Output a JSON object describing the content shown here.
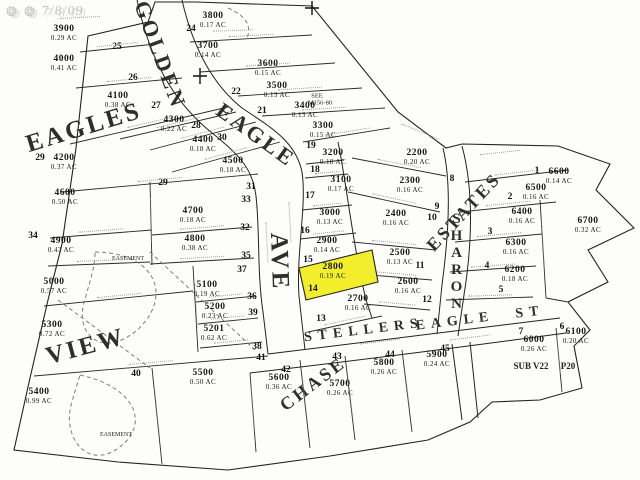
{
  "watermark": {
    "icon": "rosette-icon",
    "icon_glyphs": "❂ ❂",
    "text": "7/8/09"
  },
  "colors": {
    "highlight": "#f3ee2c",
    "line": "#222222",
    "paper": "#fdfdfc",
    "watermark": "#c4c4c4"
  },
  "highlighted_lot": {
    "id": "2800",
    "area": "0.19 AC",
    "lot_no": "14"
  },
  "streets": [
    {
      "name": "GOLDEN",
      "x": 160,
      "y": 55,
      "rot": 70,
      "size": 22
    },
    {
      "name": "EAGLE",
      "x": 256,
      "y": 135,
      "rot": 36,
      "size": 22
    },
    {
      "name": "AVE",
      "x": 279,
      "y": 262,
      "rot": 88,
      "size": 25
    },
    {
      "name": "EAGLES",
      "x": 84,
      "y": 128,
      "rot": -17,
      "size": 25
    },
    {
      "name": "VIEW",
      "x": 86,
      "y": 347,
      "rot": -15,
      "size": 25
    },
    {
      "name": "ESTATES",
      "x": 464,
      "y": 212,
      "rot": -47,
      "size": 18
    },
    {
      "name": "SHARON",
      "x": 456,
      "y": 262,
      "rot": 0,
      "size": 15,
      "vertical": true
    },
    {
      "name": "CHASE",
      "x": 313,
      "y": 384,
      "rot": -37,
      "size": 18
    },
    {
      "name": "STELLERS",
      "x": 364,
      "y": 331,
      "rot": -7,
      "size": 14,
      "spaced": true
    },
    {
      "name": "EAGLE",
      "x": 455,
      "y": 322,
      "rot": -7,
      "size": 14,
      "spaced": true
    },
    {
      "name": "ST",
      "x": 530,
      "y": 313,
      "rot": -7,
      "size": 14,
      "spaced": true
    }
  ],
  "lots": [
    {
      "id": "3900",
      "area": "0.29 AC",
      "x": 64,
      "y": 34
    },
    {
      "id": "3800",
      "area": "0.17 AC",
      "x": 213,
      "y": 21
    },
    {
      "id": "3700",
      "area": "0.14 AC",
      "x": 208,
      "y": 51
    },
    {
      "id": "3600",
      "area": "0.15 AC",
      "x": 268,
      "y": 69
    },
    {
      "id": "3500",
      "area": "0.13 AC",
      "x": 277,
      "y": 91
    },
    {
      "id": "3400",
      "area": "0.13 AC",
      "x": 305,
      "y": 111
    },
    {
      "id": "3300",
      "area": "0.15 AC",
      "x": 323,
      "y": 131
    },
    {
      "id": "3200",
      "area": "0.18 AC",
      "x": 333,
      "y": 158
    },
    {
      "id": "3100",
      "area": "0.17 AC",
      "x": 341,
      "y": 185
    },
    {
      "id": "3000",
      "area": "0.13 AC",
      "x": 330,
      "y": 218
    },
    {
      "id": "2900",
      "area": "0.14 AC",
      "x": 327,
      "y": 246
    },
    {
      "id": "2800",
      "area": "0.19 AC",
      "x": 333,
      "y": 272,
      "highlight": true
    },
    {
      "id": "2700",
      "area": "0.16 AC",
      "x": 358,
      "y": 304
    },
    {
      "id": "2200",
      "area": "0.20 AC",
      "x": 417,
      "y": 158
    },
    {
      "id": "2300",
      "area": "0.16 AC",
      "x": 410,
      "y": 186
    },
    {
      "id": "2400",
      "area": "0.16 AC",
      "x": 396,
      "y": 219
    },
    {
      "id": "2500",
      "area": "0.13 AC",
      "x": 400,
      "y": 258
    },
    {
      "id": "2600",
      "area": "0.16 AC",
      "x": 408,
      "y": 287
    },
    {
      "id": "4000",
      "area": "0.41 AC",
      "x": 64,
      "y": 64
    },
    {
      "id": "4100",
      "area": "0.38 AC",
      "x": 118,
      "y": 101
    },
    {
      "id": "4300",
      "area": "0.22 AC",
      "x": 174,
      "y": 125
    },
    {
      "id": "4400",
      "area": "0.18 AC",
      "x": 203,
      "y": 145
    },
    {
      "id": "4500",
      "area": "0.18 AC",
      "x": 233,
      "y": 166
    },
    {
      "id": "4200",
      "area": "0.37 AC",
      "x": 64,
      "y": 163
    },
    {
      "id": "4600",
      "area": "0.50 AC",
      "x": 65,
      "y": 198
    },
    {
      "id": "4700",
      "area": "0.18 AC",
      "x": 193,
      "y": 216
    },
    {
      "id": "4800",
      "area": "0.38 AC",
      "x": 195,
      "y": 244
    },
    {
      "id": "4900",
      "area": "0.43 AC",
      "x": 61,
      "y": 246
    },
    {
      "id": "5000",
      "area": "0.57 AC",
      "x": 54,
      "y": 287
    },
    {
      "id": "5100",
      "area": "0.19 AC",
      "x": 207,
      "y": 290
    },
    {
      "id": "5200",
      "area": "0.23 AC",
      "x": 215,
      "y": 312
    },
    {
      "id": "5201",
      "area": "0.62 AC",
      "x": 214,
      "y": 334
    },
    {
      "id": "5300",
      "area": "0.72 AC",
      "x": 52,
      "y": 330
    },
    {
      "id": "5400",
      "area": "0.99 AC",
      "x": 39,
      "y": 397
    },
    {
      "id": "5500",
      "area": "0.50 AC",
      "x": 203,
      "y": 378
    },
    {
      "id": "5600",
      "area": "0.36 AC",
      "x": 279,
      "y": 383
    },
    {
      "id": "5700",
      "area": "0.26 AC",
      "x": 340,
      "y": 389
    },
    {
      "id": "5800",
      "area": "0.26 AC",
      "x": 384,
      "y": 368
    },
    {
      "id": "5900",
      "area": "0.24 AC",
      "x": 437,
      "y": 360
    },
    {
      "id": "6000",
      "area": "0.26 AC",
      "x": 534,
      "y": 345
    },
    {
      "id": "6100",
      "area": "0.20 AC",
      "x": 576,
      "y": 337
    },
    {
      "id": "6200",
      "area": "0.18 AC",
      "x": 515,
      "y": 275
    },
    {
      "id": "6300",
      "area": "0.16 AC",
      "x": 516,
      "y": 248
    },
    {
      "id": "6400",
      "area": "0.16 AC",
      "x": 522,
      "y": 217
    },
    {
      "id": "6500",
      "area": "0.16 AC",
      "x": 536,
      "y": 193
    },
    {
      "id": "6600",
      "area": "0.14 AC",
      "x": 559,
      "y": 177
    },
    {
      "id": "6700",
      "area": "0.32 AC",
      "x": 588,
      "y": 226
    }
  ],
  "lot_numbers": [
    {
      "n": "25",
      "x": 117,
      "y": 47
    },
    {
      "n": "26",
      "x": 133,
      "y": 78
    },
    {
      "n": "27",
      "x": 156,
      "y": 106
    },
    {
      "n": "28",
      "x": 196,
      "y": 126
    },
    {
      "n": "29",
      "x": 40,
      "y": 158
    },
    {
      "n": "29",
      "x": 163,
      "y": 183
    },
    {
      "n": "30",
      "x": 222,
      "y": 138
    },
    {
      "n": "31",
      "x": 251,
      "y": 187
    },
    {
      "n": "33",
      "x": 246,
      "y": 200
    },
    {
      "n": "32",
      "x": 245,
      "y": 228
    },
    {
      "n": "34",
      "x": 33,
      "y": 236
    },
    {
      "n": "35",
      "x": 246,
      "y": 256
    },
    {
      "n": "37",
      "x": 242,
      "y": 270
    },
    {
      "n": "36",
      "x": 252,
      "y": 297
    },
    {
      "n": "39",
      "x": 253,
      "y": 313
    },
    {
      "n": "38",
      "x": 257,
      "y": 347
    },
    {
      "n": "41",
      "x": 261,
      "y": 358
    },
    {
      "n": "40",
      "x": 136,
      "y": 374
    },
    {
      "n": "42",
      "x": 286,
      "y": 370
    },
    {
      "n": "43",
      "x": 337,
      "y": 357
    },
    {
      "n": "44",
      "x": 390,
      "y": 355
    },
    {
      "n": "45",
      "x": 445,
      "y": 349
    },
    {
      "n": "24",
      "x": 191,
      "y": 29
    },
    {
      "n": "22",
      "x": 236,
      "y": 92
    },
    {
      "n": "21",
      "x": 262,
      "y": 111
    },
    {
      "n": "19",
      "x": 311,
      "y": 146
    },
    {
      "n": "18",
      "x": 315,
      "y": 170
    },
    {
      "n": "17",
      "x": 310,
      "y": 196
    },
    {
      "n": "16",
      "x": 305,
      "y": 231
    },
    {
      "n": "15",
      "x": 308,
      "y": 260
    },
    {
      "n": "14",
      "x": 313,
      "y": 289
    },
    {
      "n": "13",
      "x": 321,
      "y": 319
    },
    {
      "n": "8",
      "x": 452,
      "y": 179
    },
    {
      "n": "9",
      "x": 437,
      "y": 207
    },
    {
      "n": "10",
      "x": 432,
      "y": 218
    },
    {
      "n": "11",
      "x": 420,
      "y": 266
    },
    {
      "n": "12",
      "x": 427,
      "y": 300
    },
    {
      "n": "1",
      "x": 537,
      "y": 171
    },
    {
      "n": "2",
      "x": 510,
      "y": 197
    },
    {
      "n": "3",
      "x": 490,
      "y": 232
    },
    {
      "n": "4",
      "x": 487,
      "y": 266
    },
    {
      "n": "5",
      "x": 501,
      "y": 290
    },
    {
      "n": "6",
      "x": 562,
      "y": 327
    },
    {
      "n": "7",
      "x": 521,
      "y": 332
    }
  ],
  "notes": [
    {
      "text": "SUB V22",
      "x": 531,
      "y": 366,
      "size": 9,
      "bold": true
    },
    {
      "text": "P20",
      "x": 568,
      "y": 366,
      "size": 9,
      "bold": true
    },
    {
      "text": "SEE",
      "x": 317,
      "y": 96,
      "size": 6.5
    },
    {
      "text": "M156-80",
      "x": 320,
      "y": 103,
      "size": 6.5
    },
    {
      "text": "EASEMENT",
      "x": 128,
      "y": 259,
      "size": 6
    },
    {
      "text": "EASEMENT",
      "x": 116,
      "y": 435,
      "size": 6
    }
  ]
}
